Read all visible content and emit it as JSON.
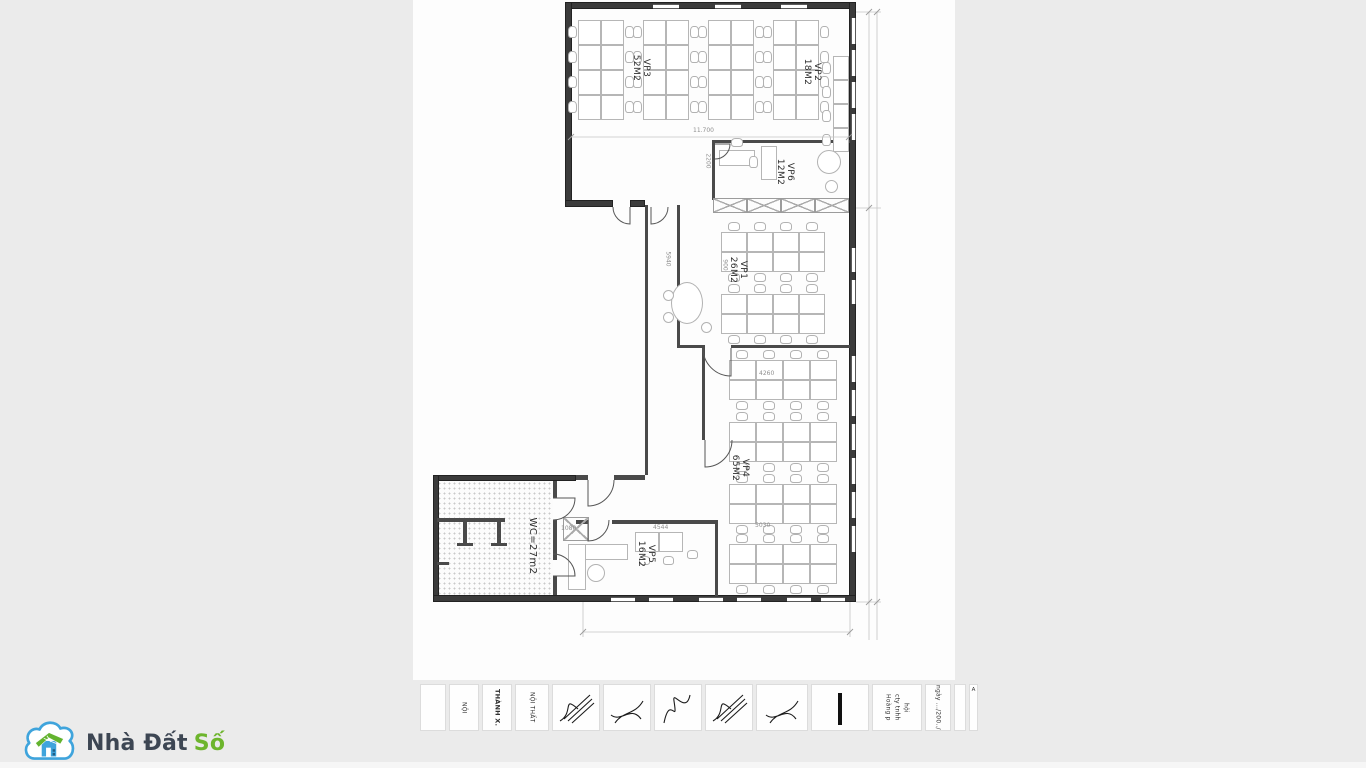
{
  "page": {
    "background": "#ebebeb",
    "sheet_background": "#fdfdfd"
  },
  "watermark": {
    "brand_prefix": "Nhà Đất",
    "brand_suffix": "Số",
    "cloud_color": "#3fa4dc",
    "roof_color": "#63b32e",
    "house_color": "#3fa4dc",
    "text_color": "#3d4653",
    "accent_color": "#6db52c"
  },
  "floorplan": {
    "rooms": [
      {
        "id": "vp3",
        "name": "VP3",
        "area": "52M2"
      },
      {
        "id": "vp2",
        "name": "VP2",
        "area": "18M2"
      },
      {
        "id": "vp6",
        "name": "VP6",
        "area": "12M2"
      },
      {
        "id": "vp1",
        "name": "VP1",
        "area": "26M2"
      },
      {
        "id": "vp4",
        "name": "VP4",
        "area": "65M2"
      },
      {
        "id": "vp5",
        "name": "VP5",
        "area": "16M2"
      },
      {
        "id": "wc",
        "name": "WC",
        "area": "27m2",
        "label": "WC=27m2"
      }
    ],
    "dim_labels": [
      {
        "text": "11.700"
      },
      {
        "text": "2200"
      },
      {
        "text": "5940"
      },
      {
        "text": "900"
      },
      {
        "text": "4260"
      },
      {
        "text": "5030"
      },
      {
        "text": "4544"
      },
      {
        "text": "1080"
      }
    ]
  },
  "title_block": {
    "cells": [
      {
        "w": 26,
        "texts": [],
        "sig": false,
        "bar": false,
        "corner": false
      },
      {
        "w": 30,
        "texts": [
          "NỘI"
        ],
        "sig": false,
        "bar": false,
        "corner": false
      },
      {
        "w": 30,
        "texts": [
          "THÀNH X."
        ],
        "sig": false,
        "bar": false,
        "corner": false,
        "bold": true
      },
      {
        "w": 34,
        "texts": [
          "NỘI THẤT"
        ],
        "sig": false,
        "bar": false,
        "corner": false
      },
      {
        "w": 48,
        "texts": [],
        "sig": true,
        "bar": false,
        "corner": false
      },
      {
        "w": 48,
        "texts": [],
        "sig": true,
        "bar": false,
        "corner": false
      },
      {
        "w": 48,
        "texts": [],
        "sig": true,
        "bar": false,
        "corner": false
      },
      {
        "w": 48,
        "texts": [],
        "sig": true,
        "bar": false,
        "corner": false
      },
      {
        "w": 52,
        "texts": [],
        "sig": true,
        "bar": false,
        "corner": false
      },
      {
        "w": 58,
        "texts": [],
        "sig": false,
        "bar": true,
        "corner": false
      },
      {
        "w": 50,
        "texts": [
          "Hoàng p",
          "cty tnhh",
          "hội"
        ],
        "sig": false,
        "bar": false,
        "corner": false
      },
      {
        "w": 26,
        "texts": [
          "ngày .../200../"
        ],
        "sig": false,
        "bar": false,
        "corner": false
      },
      {
        "w": 12,
        "texts": [],
        "sig": false,
        "bar": false,
        "corner": false
      },
      {
        "w": 9,
        "texts": [
          "A"
        ],
        "sig": false,
        "bar": false,
        "corner": true
      }
    ]
  }
}
